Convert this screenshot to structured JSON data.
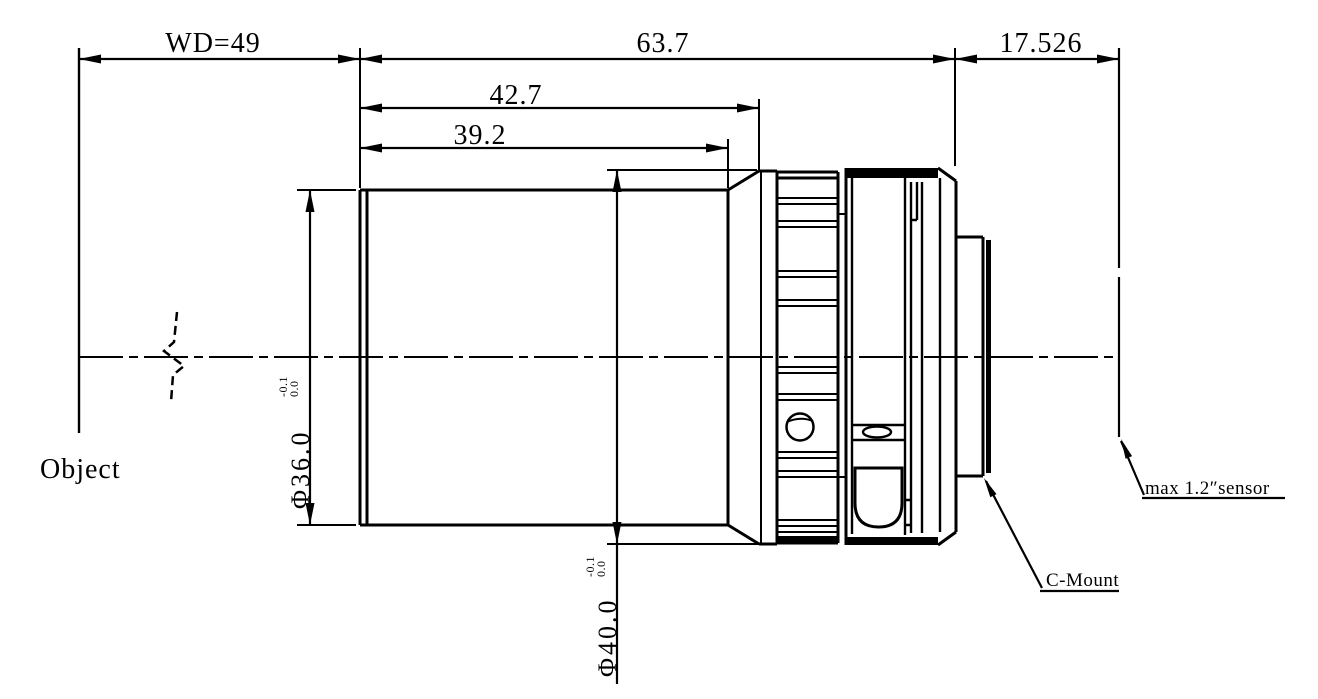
{
  "drawing": {
    "dims": {
      "working_distance": "WD=49",
      "optical_total": "63.7",
      "flange_back": "17.526",
      "front_section": "42.7",
      "barrel_section": "39.2",
      "dia_front": "Φ36.0",
      "dia_front_tol_upper": "0.0",
      "dia_front_tol_lower": "-0.1",
      "dia_ring": "Φ40.0",
      "dia_ring_tol_upper": "0.0",
      "dia_ring_tol_lower": "-0.1"
    },
    "labels": {
      "object": "Object",
      "mount": "C-Mount",
      "sensor": "max 1.2″sensor"
    },
    "colors": {
      "line": "#000000",
      "background": "#ffffff"
    }
  }
}
